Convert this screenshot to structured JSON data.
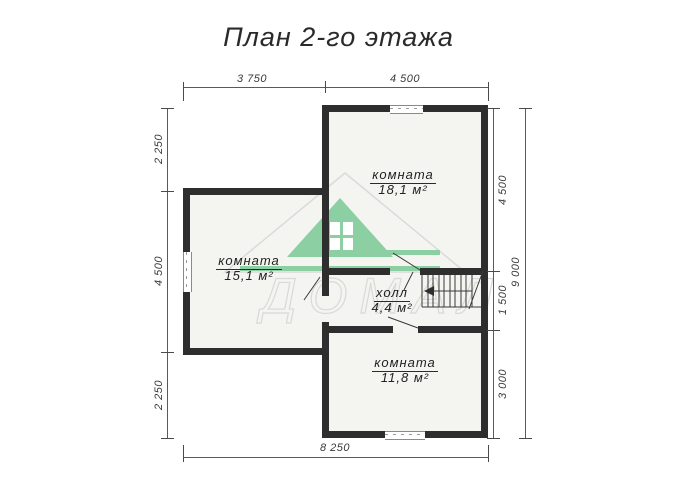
{
  "title": "План 2-го этажа",
  "plan": {
    "rooms": [
      {
        "name": "комната",
        "area": "18,1 м²"
      },
      {
        "name": "комната",
        "area": "15,1 м²"
      },
      {
        "name": "холл",
        "area": "4,4 м²"
      },
      {
        "name": "комната",
        "area": "11,8 м²"
      }
    ]
  },
  "dimensions": {
    "top": [
      "3 750",
      "4 500"
    ],
    "left": [
      "2 250",
      "4 500",
      "2 250"
    ],
    "right_inner": [
      "4 500",
      "1 500",
      "3 000"
    ],
    "right_outer": "9 000",
    "bottom": "8 250"
  },
  "watermark": {
    "text": "ДОМАЛ"
  },
  "colors": {
    "wall": "#2e2e2e",
    "floor": "#f4f4f1",
    "logo_green": "#8ccfa2",
    "dimension_text": "#3a3a3a",
    "background": "#ffffff"
  }
}
